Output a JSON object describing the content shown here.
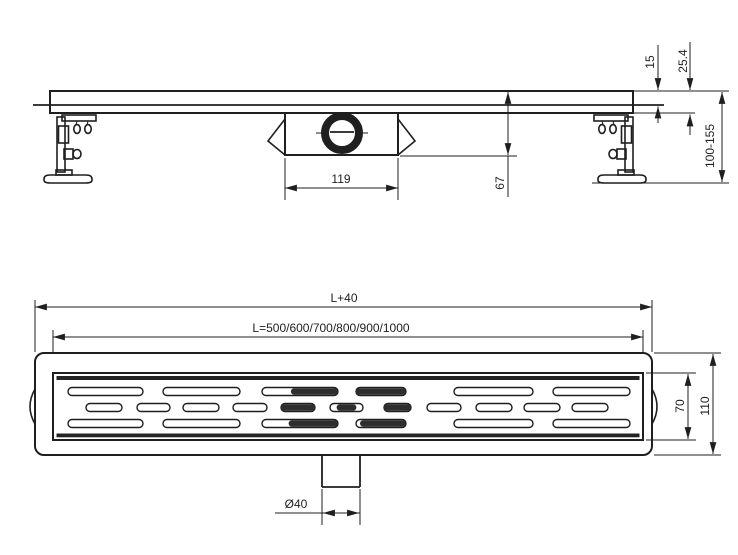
{
  "drawing_type": "linear shower drain technical drawing, two orthographic views",
  "colors": {
    "line": "#1f1f1f",
    "background": "#ffffff",
    "slot_dark_fill": "#2e2e2e"
  },
  "side_view": {
    "name": "side elevation",
    "dim_grate_thickness": "15",
    "dim_edge_height": "25.4",
    "dim_adjustable_height": "100-155",
    "dim_trap_body_width": "119",
    "dim_trap_depth": "67"
  },
  "plan_view": {
    "name": "plan view",
    "dim_overall_length": "L+40",
    "dim_channel_lengths": "L=500/600/700/800/900/1000",
    "dim_grate_width": "70",
    "dim_overall_width": "110",
    "dim_outlet_diameter": "Ø40",
    "grate": {
      "rows": [
        {
          "y": 387.5,
          "h": 8,
          "slots": [
            {
              "x": 68,
              "w": 75
            },
            {
              "x": 163,
              "w": 77
            },
            {
              "x": 262,
              "w": 76,
              "dark": [
                0.38,
                1
              ]
            },
            {
              "x": 356,
              "w": 50,
              "dark": [
                0,
                1
              ]
            },
            {
              "x": 454,
              "w": 79
            },
            {
              "x": 553,
              "w": 77
            }
          ]
        },
        {
          "y": 403.5,
          "h": 8,
          "slots": [
            {
              "x": 86,
              "w": 36
            },
            {
              "x": 137,
              "w": 33
            },
            {
              "x": 183,
              "w": 36
            },
            {
              "x": 233,
              "w": 34
            },
            {
              "x": 281,
              "w": 34,
              "dark": [
                0,
                1
              ]
            },
            {
              "x": 330,
              "w": 33,
              "dark": [
                0.2,
                0.8
              ]
            },
            {
              "x": 384,
              "w": 27,
              "dark": [
                0,
                1
              ]
            },
            {
              "x": 427,
              "w": 34
            },
            {
              "x": 476,
              "w": 36
            },
            {
              "x": 524,
              "w": 36
            },
            {
              "x": 572,
              "w": 36
            }
          ]
        },
        {
          "y": 419.5,
          "h": 8,
          "slots": [
            {
              "x": 68,
              "w": 75
            },
            {
              "x": 163,
              "w": 77
            },
            {
              "x": 262,
              "w": 76,
              "dark": [
                0.35,
                1
              ]
            },
            {
              "x": 356,
              "w": 50,
              "dark": [
                0.08,
                1
              ]
            },
            {
              "x": 454,
              "w": 79
            },
            {
              "x": 553,
              "w": 77
            }
          ]
        }
      ]
    }
  }
}
